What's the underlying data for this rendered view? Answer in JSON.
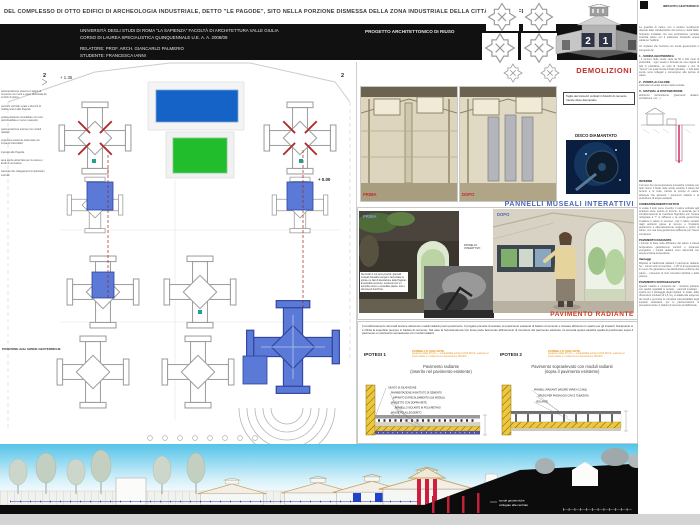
{
  "board": {
    "title": "DEL COMPLESSO DI OTTO EDIFICI DI ARCHEOLOGIA INDUSTRIALE, DETTO \"LE PAGODE\", SITO NELLA PORZIONE DISMESSA DELLA ZONA INDUSTRIALE DELLA CITTÀ DI COLLEFERRO",
    "number_left": "2",
    "number_right": "1"
  },
  "header": {
    "university_line1": "UNIVERSITÀ DEGLI STUDI DI ROMA \"LA SAPIENZA\"  FACOLTÀ DI ARCHITETTURA VALLE GIULIA",
    "university_line2": "CORSO DI LAUREA SPECIALISTICA QUINQUENNALE U.E.       A. A. 2008/09",
    "relatore": "RELATORE: PROF. ARCH. GIANCARLO PALMERIO",
    "studente": "STUDENTE: FRANCESCA IANNI",
    "project_title": "PROGETTO ARCHITETTONICO DI RIUSO"
  },
  "plan": {
    "section_marker_left": "2",
    "section_marker_right": "2",
    "level_plus": "+ 1.35",
    "level_zero": "+ 0.00",
    "sonde_note": "POSIZIONE delle SONDE GEOTERMICHE",
    "margin_notes": [
      "pavimentazione esterna in lastre di cemento con inerti a vista, delimitata da cordoli di pietra",
      "percorsi verticali: scale e blocchi di risalita interni alle Pagode",
      "solaio esistente consolidato con rete elettrosaldata e nuovo massetto",
      "pavimentazione interna con moduli radianti",
      "copertura esistente sistemata con impianti fotovoltaici",
      "ingressi alle Pagode",
      "area verde attrezzata per la sosta e i livelli di normativa",
      "tracciato dei collegamenti impiantistici interrati"
    ]
  },
  "demolizioni": {
    "heading": "DEMOLIZIONI",
    "note": "Taglio dei tramezzi verticali in blocchi di cemento, tramite disco diamantato",
    "label_prima": "PRIMA",
    "label_dopo": "DOPO",
    "disco_label": "DISCO DIAMANTATO"
  },
  "musei": {
    "heading": "PANNELLI MUSEALI INTERATTIVI",
    "label_prima": "PRIMA",
    "label_dopo": "DOPO",
    "panel_label_1": "PANNELLO",
    "panel_label_2": "INTERATTIVO",
    "caption": "Nei locali in cui sono previsti i pannelli museali interattivi vengono raccontate la storia e le fasi di lavorazione delle Pagode. È possibile scorrere i contenuti con un semplice tocco e consultare piante, foto e documenti d'archivio."
  },
  "radiante": {
    "heading": "PAVIMENTO RADIANTE",
    "intro": "Il condizionamento dei locali avviene attraverso moduli radianti posti a pavimento. Il progetto prevede di scavare nel pavimento esistente di battuto di cemento e ricavare all'interno lo spazio per gli impianti; fisicamente si è rifinita la superficie (sempre in battuto di cemento). Nel caso la Sovrintendenza non fosse parte favorevole all'intervento di rimozione del pavimento esistente, la seconda ipotesi sarebbe quella di posizionare sopra il pavimento un pavimento sopraelevato con moduli radianti.",
    "ipotesi1": "IPOTESI 1",
    "ipotesi2": "IPOTESI 2",
    "isolante1_title": "PANNELLO ISOLANTE",
    "isolante1_sub": "spessore totale 35 mm — conducibilità termica 0,022 W/mK; reazione al fuoco classe 1; resistenza a compressione 150 kPa",
    "isolante2_title": "PANNELLO ISOLANTE",
    "isolante2_sub": "spessore totale 35 mm — conducibilità termica 0,022 W/mK; reazione al fuoco classe 1; resistenza a compressione 150 kPa",
    "caption1_line1": "Pavimento radiante",
    "caption1_line2": "(inserito nel pavimento esistente)",
    "caption2_line1": "Pavimento sopraelevato con moduli radianti",
    "caption2_line2": "(sopra il pavimento esistente)",
    "detail1_layers": [
      "GIUNTO DI DILATAZIONE",
      "PAVIMENTAZIONE IN BATTUTO DI CEMENTO",
      "IMPIANTO DI RISCALDAMENTO (SUI MODULI)",
      "MASSETTO CON DOPPIA RETE",
      "PANNELLO ISOLANTE IN POLIURETANO",
      "MASSETTO ALLEGGERITO"
    ],
    "detail2_layers": [
      "PANNELLI RADIANTI (MISURE VARIE A 1,5 MQ)",
      "SPAZIO PER PASSAGGIO CAVI E TUBAZIONI",
      "ISOLANTE"
    ]
  },
  "sezione": {
    "label_line1": "sonde geotermiche",
    "label_line2": "collegate alla centrale"
  },
  "right_column": {
    "header": "IMPIANTO GEOTERMICO",
    "blocks": [
      {
        "heading": "",
        "body": "La quantità di calore con il relativo rendimento dipende dalle caratteristiche del terreno e della falda; l'impianto installato con una perforazione verticale scambia calore con il sottosuolo ricavando acqua calda per l'edificio."
      },
      {
        "heading": "",
        "body": "Un impianto che funziona con sonde geotermiche è composto da:"
      },
      {
        "heading": "1 - SONDA GEOTERMICA",
        "body": "- il numero delle sonde varia da 50 a 100 metri di profondità; - ogni sonda è formata da una coppia di tubi in polietilene, un tubo di \"andata\" e uno di \"ritorno\" nei quali circola il fluido glicolato; - i tubi delle sonde sono collegati e convergono alla pompa di calore."
      },
      {
        "heading": "2 - POMPA di CALORE",
        "body": "collocata nel locale tecnico della centrale."
      },
      {
        "heading": "3 - SISTEMA di DISTRIBUZIONE",
        "body": "all'interno dell'ambiente (pavimenti radianti, ventilazione, ecc...)"
      },
      {
        "heading": "INVERNO",
        "body": "Il terreno ha una temperatura pressoché costante per tutto l'anno; il fluido nelle sonde assorbe il calore del terreno e lo cede, tramite la pompa di calore, all'acqua che alimenta i pavimenti radianti e la produzione di acqua sanitaria."
      },
      {
        "heading": "CONDIZIONAMENTO ESTIVO",
        "body": "In estate il ciclo viene invertito: il calore sottratto agli ambienti viene ceduto al terreno. In generale per il condizionamento la macchina frigorifera con l'acqua refrigerata a 7° si raffresca e la sonda geotermica smaltisce il calore in eccesso; così il calore estratto dagli ambienti passa al terreno e l'impianto geotermico è alternativamente sorgente e pozzo di calore, con una resa geotermica sufficiente per l'intero complesso."
      },
      {
        "heading": "PAVIMENTO RADIANTE",
        "body": "I principi di base sulla diffusione del calore a bassa temperatura garantiscono comfort e risparmio energetico; i moduli radianti sono alimentati con acqua a bassa temperatura."
      },
      {
        "heading": "Vantaggi",
        "body": "Rispetto ai tradizionali radiatori il pavimento radiante ha: - minori costi di esercizio; - il 25 % di temperatura in meno che garantisce una distribuzione uniforme del calore; - l'assenza di moti convettivi dell'aria e della polvere."
      },
      {
        "heading": "PAVIMENTO SOPRAELEVATO",
        "body": "Questo modulo è composto da: - struttura portante con piedini regolabili in acciaio; - pannelli modulari; - spazio per il passaggio degli impianti. In totale, dalle dimensioni modulari di 1,5 mq, si adatta alle esigenze dei locali e permette la completa ispezionabilità degli impianti sottostanti; per le pavimentazioni si prevedono lastre in battuto di cemento prefabbricate."
      }
    ]
  }
}
